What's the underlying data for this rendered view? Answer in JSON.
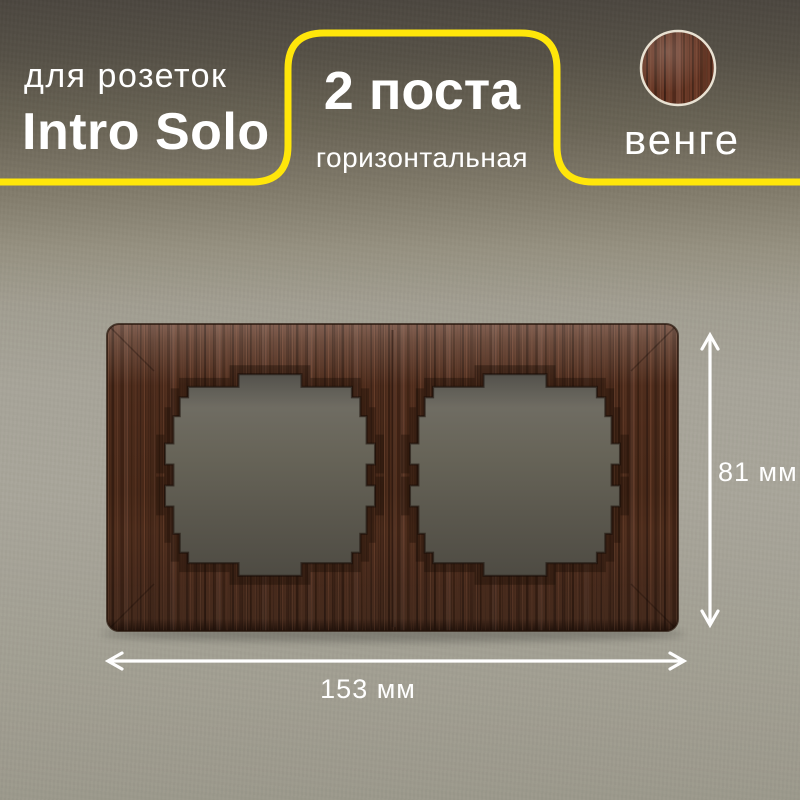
{
  "badges": {
    "product_line": {
      "subtitle": "для розеток",
      "title": "Intro Solo"
    },
    "configuration": {
      "title": "2 поста",
      "subtitle": "горизонтальная"
    },
    "finish": {
      "label": "венге"
    }
  },
  "dimensions": {
    "height": "81 мм",
    "width": "153 мм"
  },
  "icons": {
    "finish_swatch": "wenge-wood-circle-swatch",
    "height_arrow": "vertical-double-arrow",
    "width_arrow": "horizontal-double-arrow"
  },
  "colors": {
    "accent_yellow": "#ffe60a",
    "wall_dark_top": "#4c4740",
    "wall_light": "#a9a69a",
    "wood_base": "#4c2b1c",
    "wood_highlight": "#7c4c36",
    "opening_gray": "#676458",
    "text": "#ffffff",
    "swatch_ring": "#e9e2d3"
  }
}
